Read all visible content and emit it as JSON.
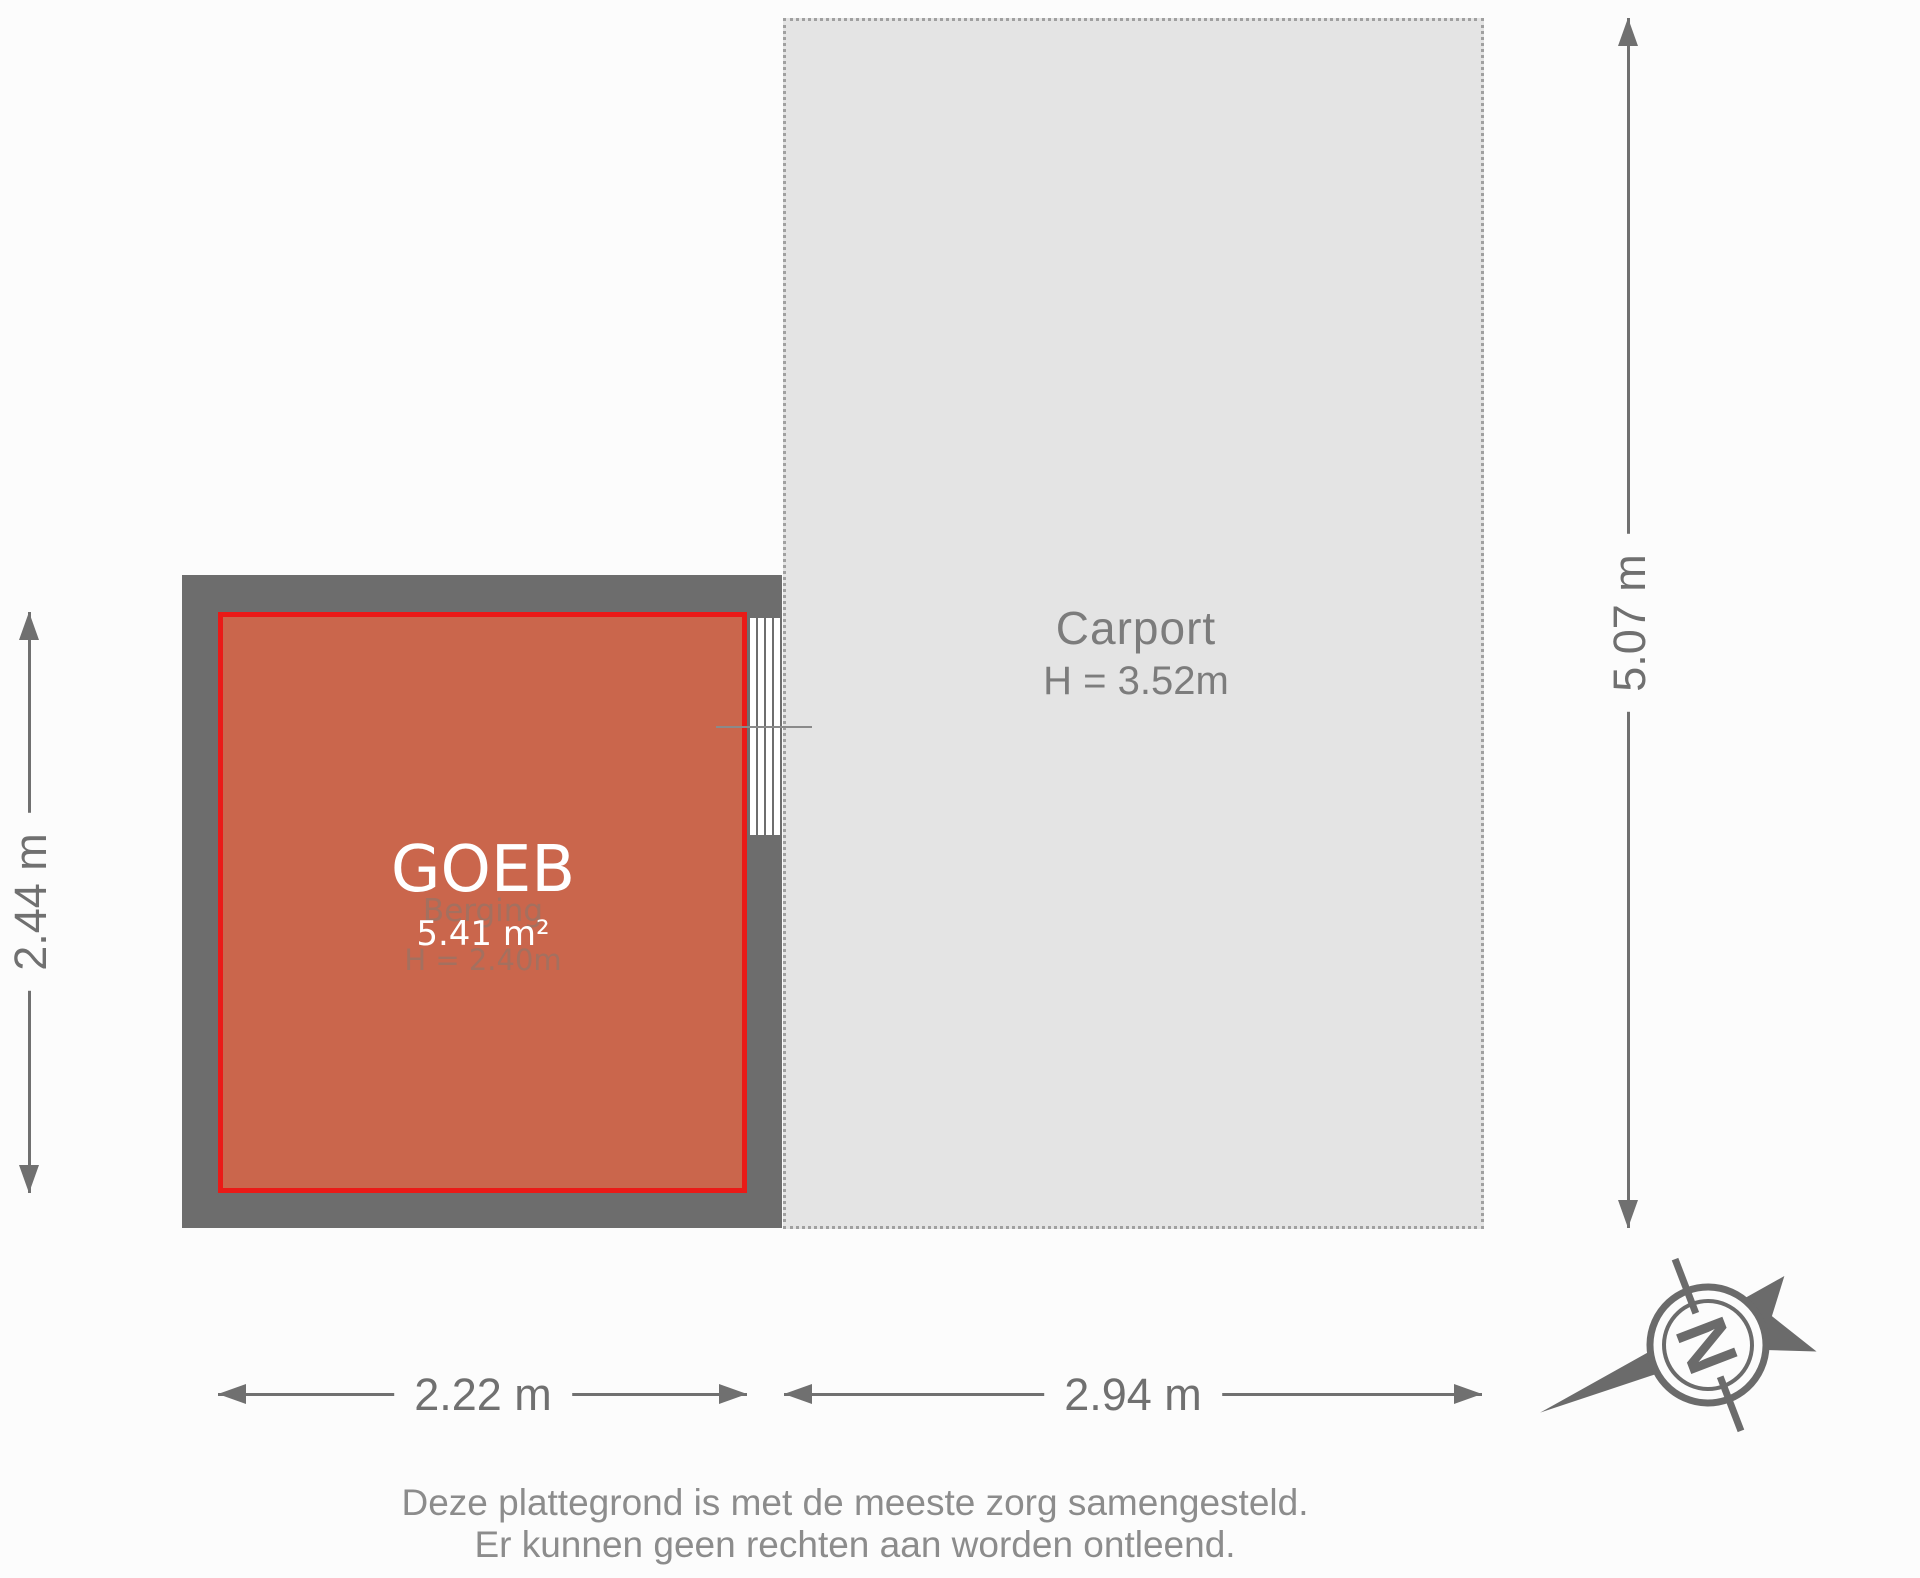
{
  "room": {
    "overlay_name": "GOEB",
    "area": "5.41 m²",
    "original_name": "Berging",
    "ceiling_height": "H = 2.40m"
  },
  "carport": {
    "name": "Carport",
    "ceiling_height": "H = 3.52m"
  },
  "dimensions": {
    "room_height": "2.44 m",
    "carport_height": "5.07 m",
    "room_width": "2.22 m",
    "carport_width": "2.94 m"
  },
  "compass": {
    "north_letter": "N"
  },
  "disclaimer": {
    "line1": "Deze plattegrond is met de meeste zorg samengesteld.",
    "line2": "Er kunnen geen rechten aan worden ontleend."
  },
  "colors": {
    "room_fill": "#ca664c",
    "room_border": "#ea1a17",
    "wall": "#6d6d6d",
    "carport_fill": "#e4e4e4",
    "carport_border": "#a0a0a0",
    "dimension": "#707070",
    "ghost_text": "#a4705f",
    "overlay_text": "#ffffff",
    "carport_text": "#7c7c7c",
    "disclaimer_text": "#8c8c8c"
  }
}
